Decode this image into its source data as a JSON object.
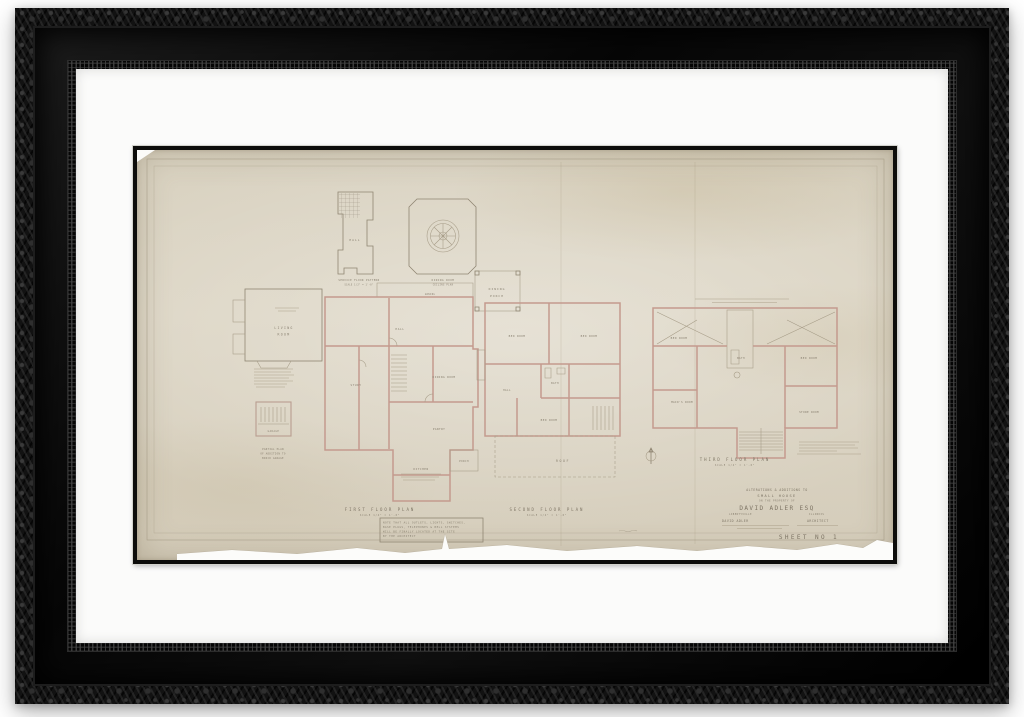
{
  "drawing": {
    "hall_plan": {
      "room": "HALL",
      "caption": [
        "SERVICE FLOOR PATTERN",
        "SCALE 1/2\" = 1'-0\""
      ]
    },
    "dining_ceiling": {
      "caption": [
        "DINING ROOM",
        "CEILING PLAN"
      ]
    },
    "dining_porch": {
      "label": [
        "DINING",
        "PORCH"
      ]
    },
    "living_room": {
      "label": [
        "LIVING",
        "ROOM"
      ]
    },
    "garage": {
      "room": "GARAGE",
      "caption": [
        "PARTIAL PLAN",
        "OF ADDITION TO",
        "BRICK GARAGE"
      ]
    },
    "first_floor": {
      "title": "FIRST FLOOR PLAN",
      "scale": "SCALE 1/4\" = 1'-0\"",
      "rooms": {
        "awning": "AWNING",
        "hall": "HALL",
        "dining": "DINING ROOM",
        "study": "STUDY",
        "pantry": "PANTRY",
        "kitchen": "KITCHEN",
        "porch": "PORCH"
      },
      "note": [
        "NOTE THAT ALL OUTLETS, LIGHTS, SWITCHES,",
        "BASE PLUGS, TELEPHONES & BELL SYSTEMS",
        "WILL BE FINALLY LOCATED AT THE SITE",
        "BY THE ARCHITECT"
      ]
    },
    "second_floor": {
      "title": "SECOND FLOOR PLAN",
      "scale": "SCALE 1/4\" = 1'-0\"",
      "roof_label": "ROOF",
      "rooms": {
        "bed1": "BED ROOM",
        "bed2": "BED ROOM",
        "bath": "BATH",
        "hall": "HALL",
        "bed3": "BED ROOM"
      }
    },
    "third_floor": {
      "title": "THIRD FLOOR PLAN",
      "scale": "SCALE 1/4\" = 1'-0\"",
      "rooms": {
        "bed1": "BED ROOM",
        "bath": "BATH",
        "bed2": "BED ROOM",
        "maids": "MAID'S ROOM",
        "store": "STORE ROOM"
      }
    },
    "title_block": {
      "line1": "ALTERATIONS & ADDITIONS TO",
      "line2": "SMALL HOUSE",
      "line3": "ON THE PROPERTY OF",
      "owner": "DAVID ADLER ESQ",
      "place_left": "LIBERTYVILLE",
      "place_right": "ILLINOIS",
      "architect_left": "DAVID ADLER",
      "architect_right": "ARCHITECT",
      "sheet": "SHEET NO 1"
    }
  },
  "colors": {
    "paper": "#d9d2c1",
    "pencil": "#8f8572",
    "wall_poche": "#c49a8e",
    "frame": "#0d0d0b",
    "mat": "#fbfbfa"
  }
}
